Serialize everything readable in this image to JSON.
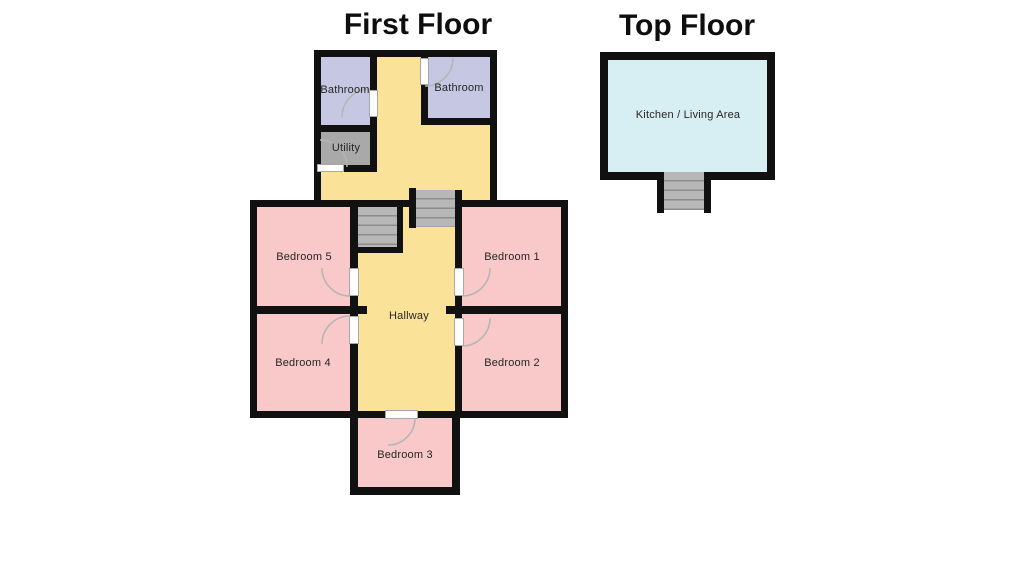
{
  "page": {
    "background": "#ffffff"
  },
  "first_floor": {
    "title": "First Floor",
    "rooms": {
      "bathroom_left": "Bathroom",
      "bathroom_right": "Bathroom",
      "utility": "Utility",
      "bedroom5": "Bedroom 5",
      "bedroom1": "Bedroom 1",
      "bedroom4": "Bedroom 4",
      "bedroom2": "Bedroom 2",
      "bedroom3": "Bedroom 3",
      "hallway": "Hallway"
    }
  },
  "top_floor": {
    "title": "Top Floor",
    "rooms": {
      "kitchen_living": "Kitchen / Living Area"
    }
  },
  "colors": {
    "wall": "#111111",
    "hallway": "#fae398",
    "bedroom": "#f8c9c8",
    "bathroom": "#c6c7e2",
    "utility": "#a9a9a9",
    "kitchen": "#d7eef3",
    "stairs": "#b7b7b7",
    "stair_line": "#8d8d8d",
    "door_arc": "#b4b4b4"
  }
}
